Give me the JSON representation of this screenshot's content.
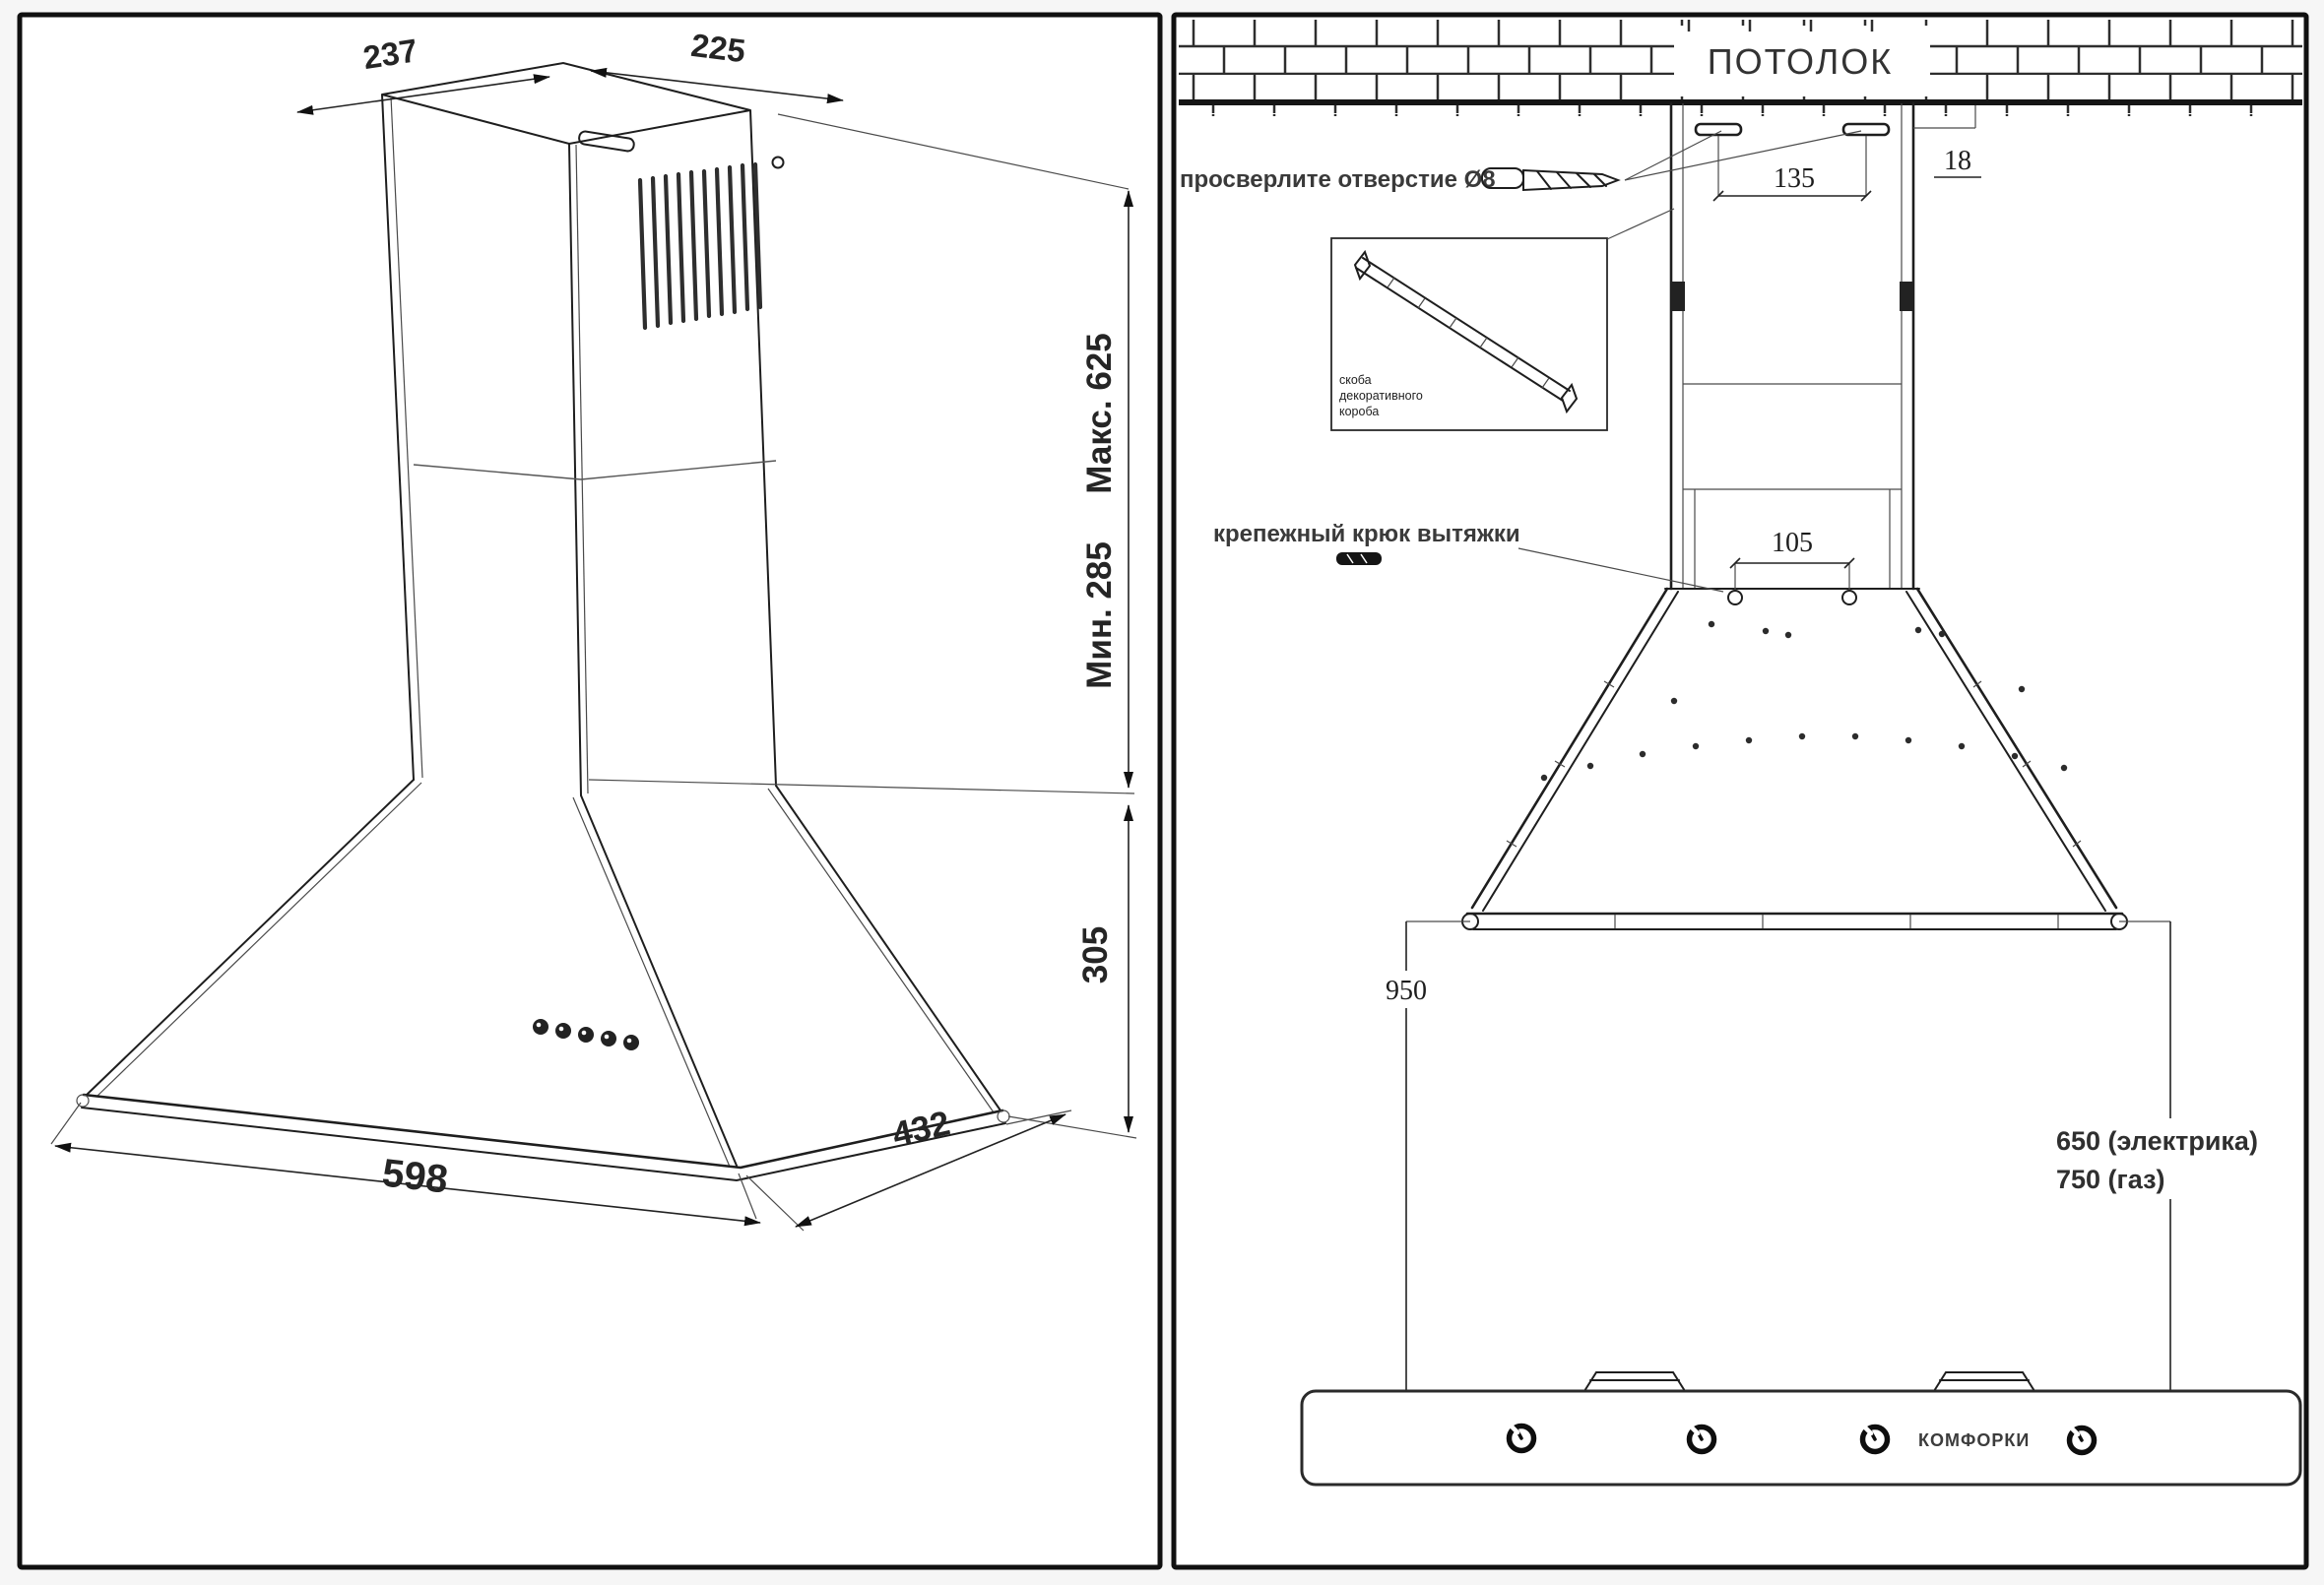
{
  "left_view": {
    "dim_top_depth": "237",
    "dim_top_width": "225",
    "dim_height_max": "Макс. 625",
    "dim_height_min": "Мин. 285",
    "dim_cone_height": "305",
    "dim_body_width": "598",
    "dim_body_depth": "432"
  },
  "front_view": {
    "ceiling_label": "ПОТОЛОК",
    "drill_instruction": "просверлите отверстие Ø8",
    "dim_hole_spacing": "135",
    "dim_wall_offset": "18",
    "bracket_caption_line1": "скоба",
    "bracket_caption_line2": "декоративного",
    "bracket_caption_line3": "короба",
    "hook_caption": "крепежный крюк вытяжки",
    "dim_hook_spacing": "105",
    "dim_height_above_hob": "950",
    "dim_clearance_electric": "650 (электрика)",
    "dim_clearance_gas": "750 (газ)",
    "hob_label": "КОМФОРКИ"
  },
  "icons": {
    "drill_bit": "drill-bit-icon",
    "mounting_hook": "hook-icon",
    "bracket_rail": "bracket-rail-icon",
    "control_knob": "knob-icon",
    "burner": "burner-icon",
    "control_buttons": "hood-buttons-icon"
  },
  "colors": {
    "line": "#1e1e1e",
    "text": "#2a2a2a",
    "background": "#f6f6f6",
    "panel": "#ffffff"
  }
}
